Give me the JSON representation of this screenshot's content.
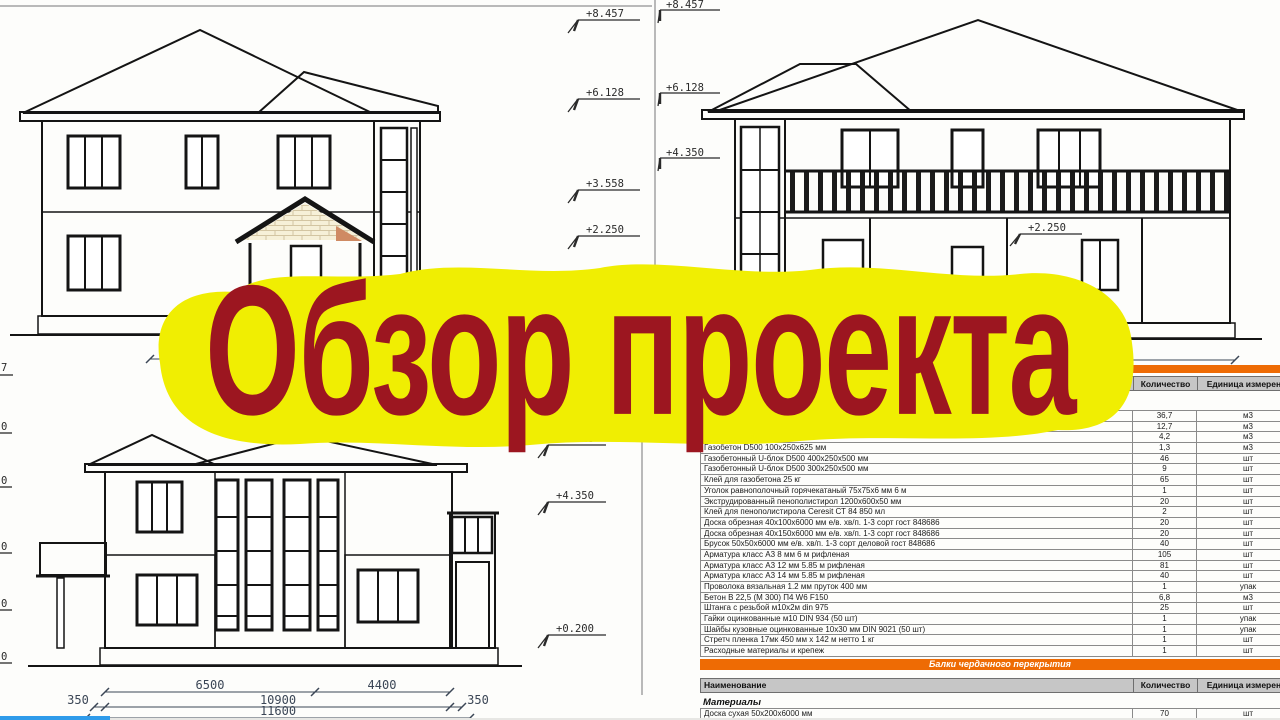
{
  "banner": {
    "text": "Обзор проекта"
  },
  "colors": {
    "banner_bg": "#f0ee02",
    "banner_text": "#9c1620",
    "band_orange": "#ee6b04",
    "header_gray": "#c6c6c6",
    "progress_blue": "#2f9bea",
    "wall_cream": "#f6f0d8",
    "wall_pink": "#f4e4d7"
  },
  "drawings": {
    "top_left": {
      "elevation_marks": [
        "+8.457",
        "+6.128",
        "+3.558",
        "+2.250"
      ],
      "dimension": "4350",
      "edge_partial": "7"
    },
    "top_right": {
      "elevation_marks": [
        "+8.457",
        "+6.128",
        "+4.350"
      ],
      "wall_mark": "+2.250",
      "dimension": "4350"
    },
    "bottom_left": {
      "elevation_marks": [
        "+6.128",
        "+4.350",
        "+0.200"
      ],
      "dims_row1": [
        "6500",
        "4400"
      ],
      "dims_row2": [
        "350",
        "10900",
        "350"
      ],
      "dims_row3": "11600",
      "edge_partials": [
        "0",
        "0",
        "0",
        "0",
        "0"
      ]
    }
  },
  "materials_table": {
    "header": {
      "name": "Наименование",
      "qty": "Количество",
      "unit": "Единица измерения"
    },
    "rows": [
      {
        "name": "",
        "qty": "36,7",
        "unit": "м3"
      },
      {
        "name": "",
        "qty": "12,7",
        "unit": "м3"
      },
      {
        "name": "",
        "qty": "4,2",
        "unit": "м3"
      },
      {
        "name": "Газобетон D500 100х250х625 мм",
        "qty": "1,3",
        "unit": "м3"
      },
      {
        "name": "Газобетонный U-блок D500 400х250х500 мм",
        "qty": "46",
        "unit": "шт"
      },
      {
        "name": "Газобетонный U-блок D500 300х250х500 мм",
        "qty": "9",
        "unit": "шт"
      },
      {
        "name": "Клей для газобетона 25 кг",
        "qty": "65",
        "unit": "шт"
      },
      {
        "name": "Уголок равнополочный горячекатаный 75х75х6 мм 6 м",
        "qty": "1",
        "unit": "шт"
      },
      {
        "name": "Экструдированный пенополистирол 1200х600х50 мм",
        "qty": "20",
        "unit": "шт"
      },
      {
        "name": "Клей для пенополистирола Ceresit СТ 84 850 мл",
        "qty": "2",
        "unit": "шт"
      },
      {
        "name": "Доска обрезная 40х100х6000 мм е/в. хв/п. 1-3 сорт гост 848686",
        "qty": "20",
        "unit": "шт"
      },
      {
        "name": "Доска обрезная 40х150х6000 мм е/в. хв/п. 1-3 сорт гост 848686",
        "qty": "20",
        "unit": "шт"
      },
      {
        "name": "Брусок 50х50х6000 мм е/в. хв/п. 1-3 сорт деловой гост 848686",
        "qty": "40",
        "unit": "шт"
      },
      {
        "name": "Арматура класс А3 8 мм 6 м рифленая",
        "qty": "105",
        "unit": "шт"
      },
      {
        "name": "Арматура класс А3 12 мм 5.85 м рифленая",
        "qty": "81",
        "unit": "шт"
      },
      {
        "name": "Арматура класс А3 14 мм 5.85 м рифленая",
        "qty": "40",
        "unit": "шт"
      },
      {
        "name": "Проволока вязальная 1.2 мм пруток 400 мм",
        "qty": "1",
        "unit": "упак"
      },
      {
        "name": "Бетон В 22,5 (М 300) П4 W6 F150",
        "qty": "6,8",
        "unit": "м3"
      },
      {
        "name": "Штанга с резьбой м10х2м din 975",
        "qty": "25",
        "unit": "шт"
      },
      {
        "name": "Гайки оцинкованные м10 DIN 934 (50 шт)",
        "qty": "1",
        "unit": "упак"
      },
      {
        "name": "Шайбы кузовные оцинкованные 10х30 мм DIN 9021 (50 шт)",
        "qty": "1",
        "unit": "упак"
      },
      {
        "name": "Стретч пленка 17мк 450 мм х 142 м нетто 1 кг",
        "qty": "1",
        "unit": "шт"
      },
      {
        "name": "Расходные материалы и крепеж",
        "qty": "1",
        "unit": "шт"
      }
    ],
    "section2": {
      "title": "Балки чердачного перекрытия",
      "group": "Материалы",
      "rows": [
        {
          "name": "Доска сухая 50х200х6000 мм",
          "qty": "70",
          "unit": "шт"
        }
      ]
    }
  }
}
